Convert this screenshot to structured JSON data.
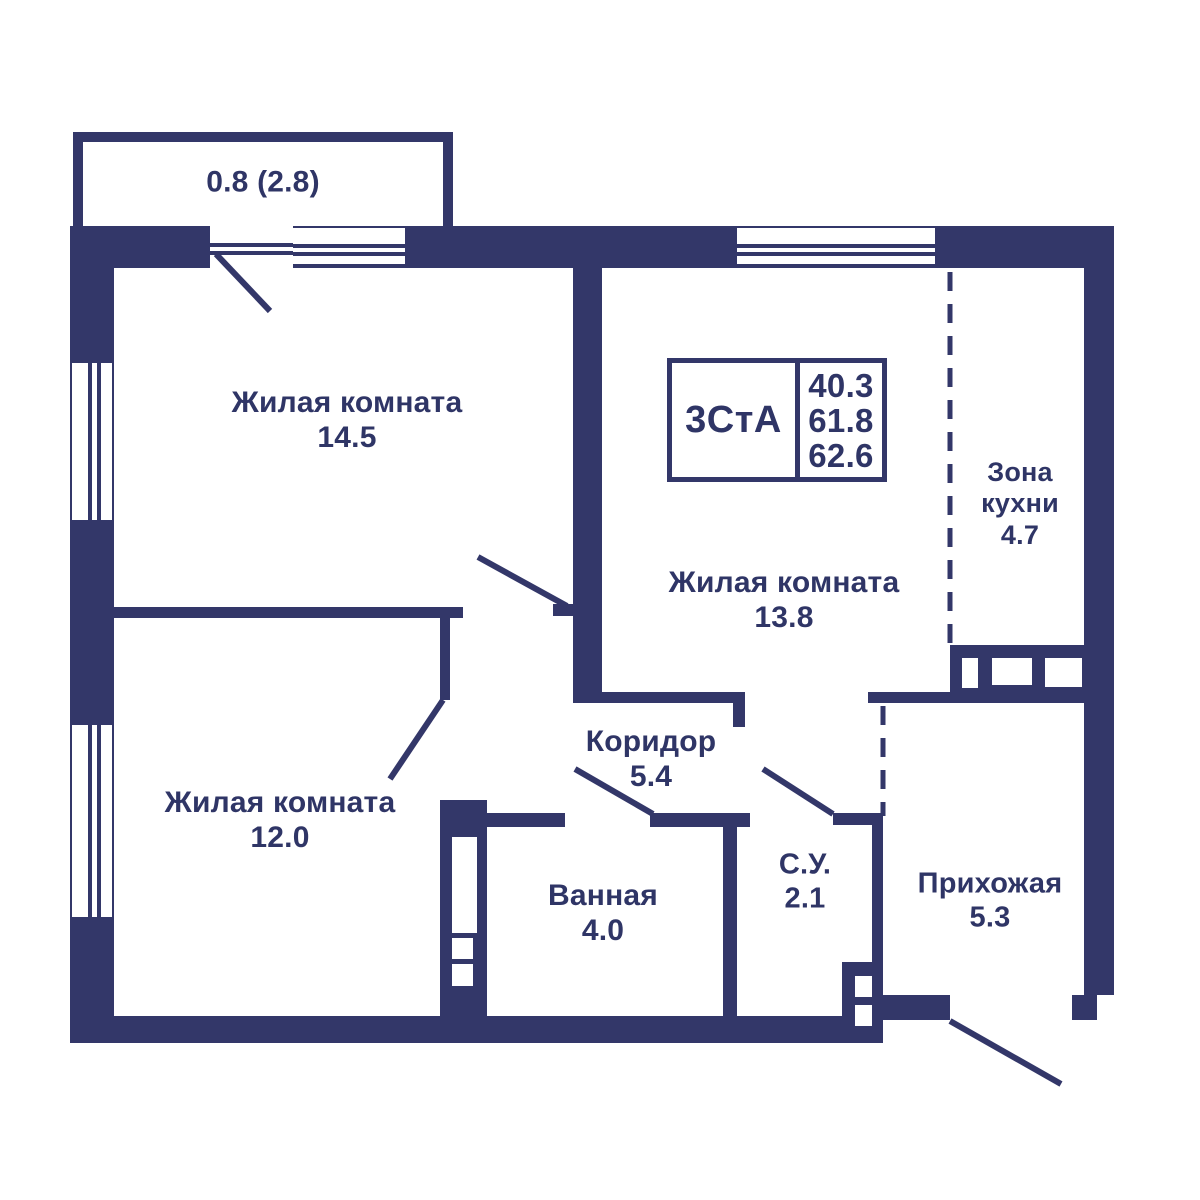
{
  "plan": {
    "unit_label": "3СтА",
    "areas": {
      "living": "40.3",
      "total": "61.8",
      "total_with_balcony": "62.6"
    },
    "balcony_label": "0.8 (2.8)",
    "colors": {
      "wall": "#333769",
      "text": "#2f3566",
      "background": "#ffffff"
    },
    "rooms": [
      {
        "name": "Жилая комната",
        "area": "14.5"
      },
      {
        "name": "Жилая комната",
        "area": "13.8"
      },
      {
        "name": "Жилая комната",
        "area": "12.0"
      },
      {
        "name": "Зона кухни",
        "area": "4.7"
      },
      {
        "name": "Коридор",
        "area": "5.4"
      },
      {
        "name": "Ванная",
        "area": "4.0"
      },
      {
        "name": "С.У.",
        "area": "2.1"
      },
      {
        "name": "Прихожая",
        "area": "5.3"
      }
    ],
    "labels": [
      {
        "name": "balcony-area-label",
        "lines": [
          "0.8 (2.8)"
        ],
        "x": 263,
        "y": 183,
        "size": 30
      },
      {
        "name": "room-label-living-1",
        "lines": [
          "Жилая комната",
          "14.5"
        ],
        "x": 347,
        "y": 421,
        "size": 30
      },
      {
        "name": "room-label-living-2",
        "lines": [
          "Жилая комната",
          "13.8"
        ],
        "x": 784,
        "y": 601,
        "size": 30
      },
      {
        "name": "room-label-kitchen",
        "lines": [
          "Зона",
          "кухни",
          "4.7"
        ],
        "x": 1020,
        "y": 504,
        "size": 27
      },
      {
        "name": "room-label-living-3",
        "lines": [
          "Жилая комната",
          "12.0"
        ],
        "x": 280,
        "y": 821,
        "size": 30
      },
      {
        "name": "room-label-corridor",
        "lines": [
          "Коридор",
          "5.4"
        ],
        "x": 651,
        "y": 760,
        "size": 30
      },
      {
        "name": "room-label-bath",
        "lines": [
          "Ванная",
          "4.0"
        ],
        "x": 603,
        "y": 914,
        "size": 30
      },
      {
        "name": "room-label-su",
        "lines": [
          "С.У.",
          "2.1"
        ],
        "x": 805,
        "y": 882,
        "size": 29
      },
      {
        "name": "room-label-hall",
        "lines": [
          "Прихожая",
          "5.3"
        ],
        "x": 990,
        "y": 901,
        "size": 29
      }
    ]
  },
  "geometry": {
    "canvas": {
      "width": 1200,
      "height": 1200
    },
    "walls": [
      {
        "name": "balcony-wall-left",
        "rect": [
          73,
          132,
          10,
          94
        ]
      },
      {
        "name": "balcony-wall-top",
        "rect": [
          73,
          132,
          380,
          10
        ]
      },
      {
        "name": "balcony-wall-right",
        "rect": [
          443,
          132,
          10,
          94
        ]
      },
      {
        "name": "outer-wall-top",
        "rect": [
          70,
          226,
          1044,
          42
        ]
      },
      {
        "name": "outer-wall-left",
        "rect": [
          70,
          226,
          44,
          817
        ]
      },
      {
        "name": "outer-wall-bottom",
        "rect": [
          70,
          1016,
          803,
          27
        ]
      },
      {
        "name": "outer-wall-right",
        "rect": [
          1084,
          226,
          30,
          769
        ]
      },
      {
        "name": "outer-wall-right-step",
        "rect": [
          1072,
          995,
          25,
          25
        ]
      },
      {
        "name": "wall-between-living1-living2",
        "rect": [
          573,
          268,
          29,
          435
        ]
      },
      {
        "name": "wall-between-living1-living3",
        "rect": [
          114,
          607,
          349,
          11
        ]
      },
      {
        "name": "door-jamb-living1",
        "rect": [
          553,
          604,
          22,
          12
        ]
      },
      {
        "name": "wall-living3-corridor",
        "rect": [
          440,
          612,
          10,
          88
        ]
      },
      {
        "name": "vent-shaft-left",
        "rect": [
          440,
          800,
          47,
          217
        ]
      },
      {
        "name": "wall-bath-top-left",
        "rect": [
          440,
          813,
          125,
          14
        ]
      },
      {
        "name": "wall-bath-top-right",
        "rect": [
          650,
          813,
          100,
          14
        ]
      },
      {
        "name": "wall-bath-su",
        "rect": [
          723,
          813,
          14,
          204
        ]
      },
      {
        "name": "wall-corridor-living2",
        "rect": [
          573,
          692,
          172,
          11
        ]
      },
      {
        "name": "wall-corridor-stub",
        "rect": [
          733,
          692,
          12,
          35
        ]
      },
      {
        "name": "wall-su-top",
        "rect": [
          833,
          813,
          50,
          12
        ]
      },
      {
        "name": "wall-su-right",
        "rect": [
          872,
          822,
          11,
          141
        ]
      },
      {
        "name": "vent-shaft-su",
        "rect": [
          842,
          962,
          41,
          81
        ]
      },
      {
        "name": "wall-hall-bottom",
        "rect": [
          873,
          995,
          77,
          25
        ]
      },
      {
        "name": "kitchen-counter",
        "rect": [
          950,
          645,
          134,
          47
        ]
      },
      {
        "name": "wall-counter-bottom",
        "rect": [
          868,
          692,
          216,
          11
        ]
      }
    ],
    "cutouts": [
      {
        "name": "vent-left-opening-1",
        "rect": [
          452,
          837,
          25,
          96
        ]
      },
      {
        "name": "vent-left-opening-2",
        "rect": [
          452,
          938,
          21,
          21
        ]
      },
      {
        "name": "vent-left-opening-3",
        "rect": [
          452,
          964,
          21,
          22
        ]
      },
      {
        "name": "vent-su-opening-1",
        "rect": [
          855,
          976,
          17,
          21
        ]
      },
      {
        "name": "vent-su-opening-2",
        "rect": [
          855,
          1005,
          17,
          21
        ]
      },
      {
        "name": "counter-opening-1",
        "rect": [
          962,
          658,
          16,
          30
        ]
      },
      {
        "name": "counter-opening-2",
        "rect": [
          992,
          658,
          40,
          27
        ]
      },
      {
        "name": "counter-opening-3",
        "rect": [
          1045,
          658,
          37,
          29
        ]
      }
    ],
    "windows": [
      {
        "name": "window-top-1",
        "rect": [
          293,
          228,
          112,
          36
        ],
        "orient": "h",
        "lines": [
          244,
          252
        ]
      },
      {
        "name": "window-top-2",
        "rect": [
          737,
          228,
          198,
          36
        ],
        "orient": "h",
        "lines": [
          244,
          252
        ]
      },
      {
        "name": "window-left-1",
        "rect": [
          72,
          363,
          40,
          157
        ],
        "orient": "v",
        "lines": [
          88,
          97
        ]
      },
      {
        "name": "window-left-2",
        "rect": [
          72,
          725,
          40,
          192
        ],
        "orient": "v",
        "lines": [
          88,
          97
        ]
      },
      {
        "name": "balcony-door-opening",
        "rect": [
          210,
          226,
          83,
          42
        ],
        "orient": "h",
        "lines": [
          243,
          251
        ]
      }
    ],
    "door_swings": [
      {
        "name": "door-swing-balcony",
        "line": [
          216,
          254,
          270,
          311
        ]
      },
      {
        "name": "door-swing-living1",
        "line": [
          478,
          557,
          567,
          606
        ]
      },
      {
        "name": "door-swing-living3",
        "line": [
          390,
          779,
          443,
          700
        ]
      },
      {
        "name": "door-swing-bath",
        "line": [
          575,
          769,
          653,
          814
        ]
      },
      {
        "name": "door-swing-su",
        "line": [
          763,
          769,
          833,
          814
        ]
      },
      {
        "name": "door-swing-entrance",
        "line": [
          950,
          1021,
          1061,
          1084
        ]
      }
    ],
    "dashed_lines": [
      {
        "name": "kitchen-zone-divider",
        "x": 950,
        "y1": 272,
        "y2": 645
      },
      {
        "name": "hall-zone-divider",
        "x": 883,
        "y1": 706,
        "y2": 816
      }
    ]
  }
}
